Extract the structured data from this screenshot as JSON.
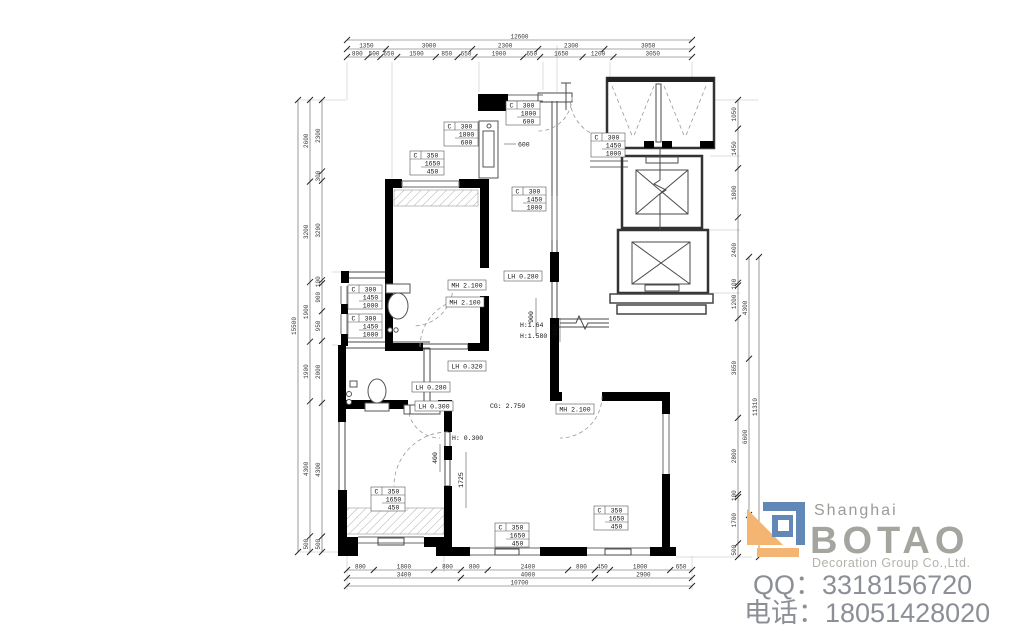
{
  "logo": {
    "shanghai": "Shanghai",
    "brand": "BOTAO",
    "subtitle": "Decoration Group Co.,Ltd.",
    "qq": "QQ：3318156720",
    "phone": "电话：18051428020",
    "orange": "#f4b573",
    "blue": "#6288b8"
  },
  "dims": {
    "top": {
      "overall": [
        "12600"
      ],
      "row2": [
        "1350",
        "3000",
        "2300",
        "2300",
        "3050"
      ],
      "row3": [
        "800",
        "500",
        "650",
        "1500",
        "850",
        "650",
        "1900",
        "650",
        "1650",
        "1200",
        "3050"
      ]
    },
    "bottom": {
      "row1": [
        "800",
        "1800",
        "800",
        "800",
        "2400",
        "800",
        "450",
        "1800",
        "650"
      ],
      "row2": [
        "3400",
        "4000",
        "2900"
      ],
      "overall": [
        "10700"
      ]
    },
    "left": {
      "overall": [
        "15500"
      ],
      "col2": [
        "2600",
        "3200",
        "1900",
        "1900",
        "4300",
        "500"
      ],
      "col3": [
        "2300",
        "300",
        "3200",
        "100",
        "900",
        "950",
        "2000",
        "4300",
        "500"
      ]
    },
    "right": {
      "col1": [
        "1050",
        "1450",
        "1800",
        "2400",
        "100",
        "1200",
        "3650",
        "2800",
        "100",
        "1700",
        "500"
      ],
      "col2": [
        "4300",
        "6600"
      ],
      "overall": [
        "11310"
      ]
    }
  },
  "window_tags": [
    {
      "mark": "C",
      "w": "300",
      "h": "1800",
      "s": "600"
    },
    {
      "mark": "C",
      "w": "300",
      "h": "1800",
      "s": "600"
    },
    {
      "mark": "C",
      "w": "350",
      "h": "1650",
      "s": "450"
    },
    {
      "mark": "C",
      "w": "300",
      "h": "1450",
      "s": "1000"
    },
    {
      "mark": "C",
      "w": "300",
      "h": "1450",
      "s": "1000"
    },
    {
      "mark": "C",
      "w": "300",
      "h": "1450",
      "s": "1000"
    },
    {
      "mark": "C",
      "w": "300",
      "h": "1450",
      "s": "1000"
    },
    {
      "mark": "C",
      "w": "350",
      "h": "1650",
      "s": "450"
    },
    {
      "mark": "C",
      "w": "350",
      "h": "1650",
      "s": "450"
    },
    {
      "mark": "C",
      "w": "350",
      "h": "1650",
      "s": "450"
    }
  ],
  "labels": [
    {
      "text": "LH 0.280"
    },
    {
      "text": "MH 2.100"
    },
    {
      "text": "MH 2.100"
    },
    {
      "text": "H:1.64"
    },
    {
      "text": "H:1.580"
    },
    {
      "text": "LH 0.320"
    },
    {
      "text": "LH 0.280"
    },
    {
      "text": "LH 0.300"
    },
    {
      "text": "CG: 2.750"
    },
    {
      "text": "MH 2.100"
    },
    {
      "text": "H: 0.300"
    },
    {
      "text": "600"
    },
    {
      "text": "900"
    },
    {
      "text": "800"
    },
    {
      "text": "400"
    },
    {
      "text": "1725"
    }
  ]
}
